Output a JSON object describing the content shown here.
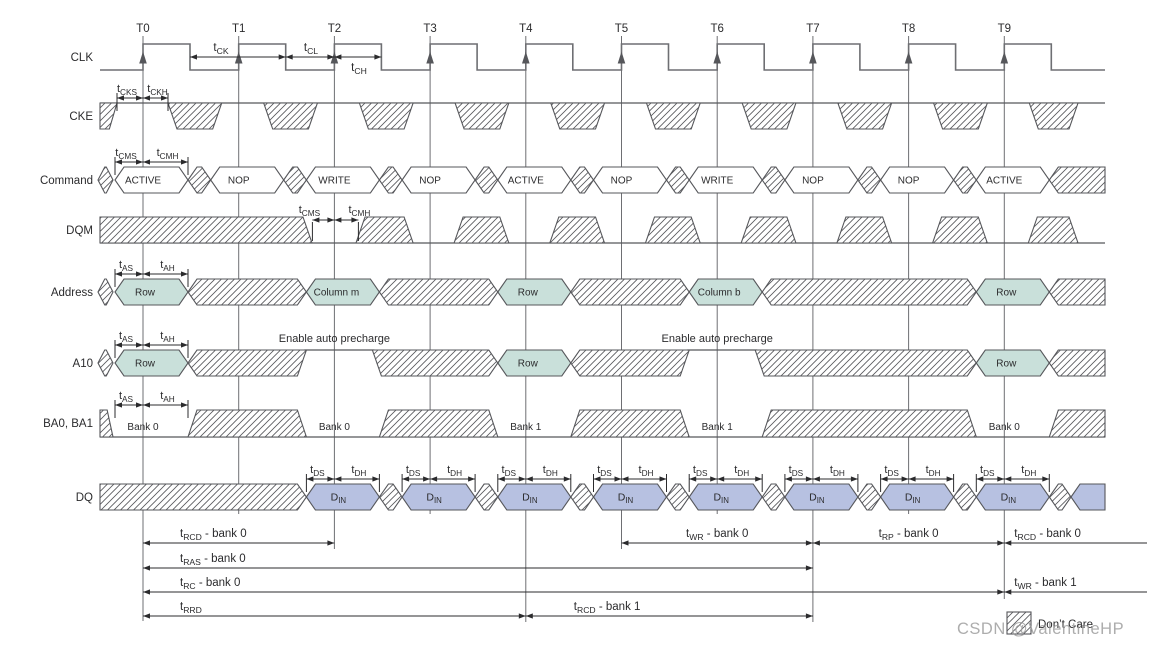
{
  "clock": {
    "label": "CLK",
    "tick_labels": [
      "T0",
      "T1",
      "T2",
      "T3",
      "T4",
      "T5",
      "T6",
      "T7",
      "T8",
      "T9"
    ],
    "timing": {
      "tck": {
        "main": "t",
        "sub": "CK"
      },
      "tcl": {
        "main": "t",
        "sub": "CL"
      },
      "tch": {
        "main": "t",
        "sub": "CH"
      }
    }
  },
  "signals": {
    "cke": {
      "label": "CKE",
      "setup": {
        "main": "t",
        "sub": "CKS"
      },
      "hold": {
        "main": "t",
        "sub": "CKH"
      }
    },
    "command": {
      "label": "Command",
      "values": [
        "ACTIVE",
        "NOP",
        "WRITE",
        "NOP",
        "ACTIVE",
        "NOP",
        "WRITE",
        "NOP",
        "NOP",
        "ACTIVE"
      ],
      "setup": {
        "main": "t",
        "sub": "CMS"
      },
      "hold": {
        "main": "t",
        "sub": "CMH"
      }
    },
    "dqm": {
      "label": "DQM",
      "setup": {
        "main": "t",
        "sub": "CMS"
      },
      "hold": {
        "main": "t",
        "sub": "CMH"
      }
    },
    "address": {
      "label": "Address",
      "values": [
        {
          "t": 0,
          "text": "Row"
        },
        {
          "t": 2,
          "text": "Column m"
        },
        {
          "t": 4,
          "text": "Row"
        },
        {
          "t": 6,
          "text": "Column b"
        },
        {
          "t": 9,
          "text": "Row"
        }
      ],
      "setup": {
        "main": "t",
        "sub": "AS"
      },
      "hold": {
        "main": "t",
        "sub": "AH"
      }
    },
    "a10": {
      "label": "A10",
      "values": [
        {
          "t": 0,
          "text": "Row"
        },
        {
          "t": 4,
          "text": "Row"
        },
        {
          "t": 9,
          "text": "Row"
        }
      ],
      "high_labels": [
        {
          "t": 2,
          "text": "Enable auto precharge"
        },
        {
          "t": 6,
          "text": "Enable auto precharge"
        }
      ],
      "setup": {
        "main": "t",
        "sub": "AS"
      },
      "hold": {
        "main": "t",
        "sub": "AH"
      }
    },
    "ba": {
      "label": "BA0, BA1",
      "values": [
        {
          "t": 0,
          "text": "Bank 0"
        },
        {
          "t": 2,
          "text": "Bank 0"
        },
        {
          "t": 4,
          "text": "Bank 1"
        },
        {
          "t": 6,
          "text": "Bank 1"
        },
        {
          "t": 9,
          "text": "Bank 0"
        }
      ],
      "setup": {
        "main": "t",
        "sub": "AS"
      },
      "hold": {
        "main": "t",
        "sub": "AH"
      }
    },
    "dq": {
      "label": "DQ",
      "din": {
        "main": "D",
        "sub": "IN"
      },
      "din_slots": [
        2,
        3,
        4,
        5,
        6,
        7,
        8,
        9
      ],
      "setup": {
        "main": "t",
        "sub": "DS"
      },
      "hold": {
        "main": "t",
        "sub": "DH"
      }
    }
  },
  "bottom_annotations": [
    {
      "label": {
        "main": "t",
        "sub": "RCD",
        "rest": " - bank 0"
      },
      "from": 0,
      "to": 2,
      "row": 0,
      "label_align": "left"
    },
    {
      "label": {
        "main": "t",
        "sub": "RAS",
        "rest": " - bank 0"
      },
      "from": 0,
      "to": 7,
      "row": 1,
      "label_align": "left"
    },
    {
      "label": {
        "main": "t",
        "sub": "RC",
        "rest": " - bank 0"
      },
      "from": 0,
      "to": 9,
      "row": 2,
      "label_align": "left"
    },
    {
      "label": {
        "main": "t",
        "sub": "RRD",
        "rest": ""
      },
      "from": 0,
      "to": 4,
      "row": 3,
      "label_align": "left"
    },
    {
      "label": {
        "main": "t",
        "sub": "WR",
        "rest": " - bank 0"
      },
      "from": 5,
      "to": 7,
      "row": 0,
      "label_align": "center"
    },
    {
      "label": {
        "main": "t",
        "sub": "RP",
        "rest": " - bank 0"
      },
      "from": 7,
      "to": 9,
      "row": 0,
      "label_align": "center"
    },
    {
      "label": {
        "main": "t",
        "sub": "RCD",
        "rest": " - bank 0"
      },
      "from": 9,
      "to": "edge",
      "row": 0,
      "label_align": "after"
    },
    {
      "label": {
        "main": "t",
        "sub": "WR",
        "rest": " - bank 1"
      },
      "from": 9,
      "to": "edge",
      "row": 2,
      "label_align": "after"
    },
    {
      "label": {
        "main": "t",
        "sub": "RCD",
        "rest": " - bank 1"
      },
      "from": 4,
      "to": 7,
      "row": 3,
      "label_align": "left2"
    }
  ],
  "legend": {
    "dont_care": "Don’t Care"
  },
  "watermark": "CSDN @ValentineHP",
  "colors": {
    "line": "#56575B",
    "clk": "#6E6F73",
    "text": "#2B2B2D",
    "teal": "#C9E0DA",
    "blue": "#B7C1E1",
    "watermark": "#9B9B9B"
  }
}
